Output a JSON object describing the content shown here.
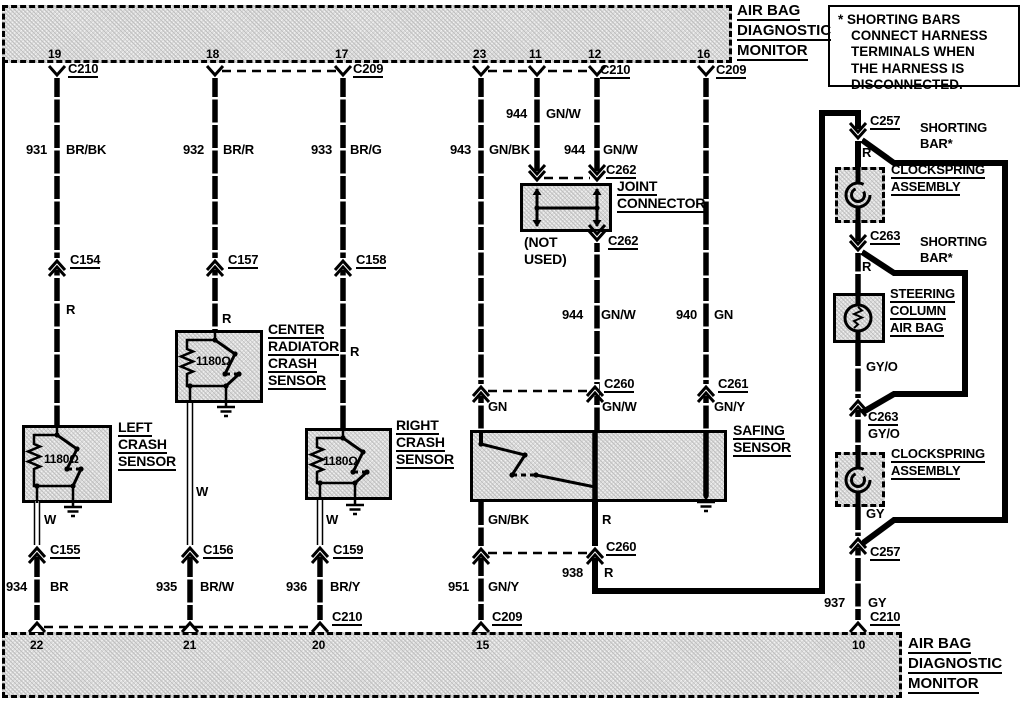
{
  "titles": {
    "top": [
      "AIR BAG",
      "DIAGNOSTIC",
      "MONITOR"
    ],
    "bottom": [
      "AIR BAG",
      "DIAGNOSTIC",
      "MONITOR"
    ]
  },
  "note": {
    "lines": [
      "* SHORTING BARS",
      "CONNECT HARNESS",
      "TERMINALS WHEN",
      "THE HARNESS IS",
      "DISCONNECTED."
    ]
  },
  "monitors": {
    "top_pins": [
      {
        "n": "19",
        "x": 48
      },
      {
        "n": "18",
        "x": 206
      },
      {
        "n": "17",
        "x": 335
      },
      {
        "n": "23",
        "x": 473
      },
      {
        "n": "11",
        "x": 529
      },
      {
        "n": "12",
        "x": 588
      },
      {
        "n": "16",
        "x": 697
      }
    ],
    "bottom_pins": [
      {
        "n": "22",
        "x": 30
      },
      {
        "n": "21",
        "x": 183
      },
      {
        "n": "20",
        "x": 312
      },
      {
        "n": "15",
        "x": 476
      },
      {
        "n": "10",
        "x": 852
      }
    ]
  },
  "labels": [
    {
      "t": "C210",
      "x": 68,
      "y": 62,
      "u": 1
    },
    {
      "t": "C209",
      "x": 353,
      "y": 62,
      "u": 1
    },
    {
      "t": "C210",
      "x": 600,
      "y": 63,
      "u": 1
    },
    {
      "t": "C209",
      "x": 716,
      "y": 63,
      "u": 1
    },
    {
      "t": "944",
      "x": 506,
      "y": 107
    },
    {
      "t": "GN/W",
      "x": 546,
      "y": 107
    },
    {
      "t": "931",
      "x": 26,
      "y": 143
    },
    {
      "t": "BR/BK",
      "x": 66,
      "y": 143
    },
    {
      "t": "932",
      "x": 183,
      "y": 143
    },
    {
      "t": "BR/R",
      "x": 223,
      "y": 143
    },
    {
      "t": "933",
      "x": 311,
      "y": 143
    },
    {
      "t": "BR/G",
      "x": 350,
      "y": 143
    },
    {
      "t": "943",
      "x": 450,
      "y": 143
    },
    {
      "t": "GN/BK",
      "x": 489,
      "y": 143
    },
    {
      "t": "944",
      "x": 564,
      "y": 143
    },
    {
      "t": "GN/W",
      "x": 603,
      "y": 143
    },
    {
      "t": "C262",
      "x": 606,
      "y": 163,
      "u": 1
    },
    {
      "t": "JOINT",
      "x": 617,
      "y": 180,
      "u": 1,
      "fs": 14
    },
    {
      "t": "CONNECTOR",
      "x": 617,
      "y": 197,
      "u": 1,
      "fs": 14
    },
    {
      "t": "(NOT",
      "x": 524,
      "y": 236,
      "fs": 14
    },
    {
      "t": "USED)",
      "x": 524,
      "y": 253,
      "fs": 14
    },
    {
      "t": "C262",
      "x": 608,
      "y": 234,
      "u": 1
    },
    {
      "t": "C154",
      "x": 70,
      "y": 253,
      "u": 1
    },
    {
      "t": "C157",
      "x": 228,
      "y": 253,
      "u": 1
    },
    {
      "t": "C158",
      "x": 356,
      "y": 253,
      "u": 1
    },
    {
      "t": "R",
      "x": 66,
      "y": 303
    },
    {
      "t": "R",
      "x": 222,
      "y": 312
    },
    {
      "t": "R",
      "x": 350,
      "y": 345
    },
    {
      "t": "CENTER",
      "x": 268,
      "y": 323,
      "u": 1,
      "fs": 14
    },
    {
      "t": "RADIATOR",
      "x": 268,
      "y": 340,
      "u": 1,
      "fs": 14
    },
    {
      "t": "CRASH",
      "x": 268,
      "y": 357,
      "u": 1,
      "fs": 14
    },
    {
      "t": "SENSOR",
      "x": 268,
      "y": 374,
      "u": 1,
      "fs": 14
    },
    {
      "t": "LEFT",
      "x": 118,
      "y": 421,
      "u": 1,
      "fs": 14
    },
    {
      "t": "CRASH",
      "x": 118,
      "y": 438,
      "u": 1,
      "fs": 14
    },
    {
      "t": "SENSOR",
      "x": 118,
      "y": 455,
      "u": 1,
      "fs": 14
    },
    {
      "t": "RIGHT",
      "x": 396,
      "y": 419,
      "u": 1,
      "fs": 14
    },
    {
      "t": "CRASH",
      "x": 396,
      "y": 436,
      "u": 1,
      "fs": 14
    },
    {
      "t": "SENSOR",
      "x": 396,
      "y": 453,
      "u": 1,
      "fs": 14
    },
    {
      "t": "1180Ω",
      "x": 44,
      "y": 453,
      "fs": 12
    },
    {
      "t": "1180Ω",
      "x": 196,
      "y": 355,
      "fs": 12
    },
    {
      "t": "1180Ω",
      "x": 323,
      "y": 455,
      "fs": 12
    },
    {
      "t": "944",
      "x": 562,
      "y": 308
    },
    {
      "t": "GN/W",
      "x": 601,
      "y": 308
    },
    {
      "t": "940",
      "x": 676,
      "y": 308
    },
    {
      "t": "GN",
      "x": 714,
      "y": 308
    },
    {
      "t": "C260",
      "x": 604,
      "y": 377,
      "u": 1
    },
    {
      "t": "C261",
      "x": 718,
      "y": 377,
      "u": 1
    },
    {
      "t": "GN",
      "x": 488,
      "y": 400
    },
    {
      "t": "GN/W",
      "x": 602,
      "y": 400
    },
    {
      "t": "GN/Y",
      "x": 714,
      "y": 400
    },
    {
      "t": "SAFING",
      "x": 733,
      "y": 424,
      "u": 1,
      "fs": 14
    },
    {
      "t": "SENSOR",
      "x": 733,
      "y": 441,
      "u": 1,
      "fs": 14
    },
    {
      "t": "GN/BK",
      "x": 488,
      "y": 513
    },
    {
      "t": "R",
      "x": 602,
      "y": 513
    },
    {
      "t": "C260",
      "x": 606,
      "y": 540,
      "u": 1
    },
    {
      "t": "938",
      "x": 562,
      "y": 566
    },
    {
      "t": "R",
      "x": 604,
      "y": 566
    },
    {
      "t": "W",
      "x": 44,
      "y": 513
    },
    {
      "t": "W",
      "x": 196,
      "y": 485
    },
    {
      "t": "W",
      "x": 326,
      "y": 513
    },
    {
      "t": "C155",
      "x": 50,
      "y": 543,
      "u": 1
    },
    {
      "t": "C156",
      "x": 203,
      "y": 543,
      "u": 1
    },
    {
      "t": "C159",
      "x": 333,
      "y": 543,
      "u": 1
    },
    {
      "t": "934",
      "x": 6,
      "y": 580
    },
    {
      "t": "BR",
      "x": 50,
      "y": 580
    },
    {
      "t": "935",
      "x": 156,
      "y": 580
    },
    {
      "t": "BR/W",
      "x": 200,
      "y": 580
    },
    {
      "t": "936",
      "x": 286,
      "y": 580
    },
    {
      "t": "BR/Y",
      "x": 330,
      "y": 580
    },
    {
      "t": "951",
      "x": 448,
      "y": 580
    },
    {
      "t": "GN/Y",
      "x": 488,
      "y": 580
    },
    {
      "t": "C210",
      "x": 332,
      "y": 610,
      "u": 1
    },
    {
      "t": "C209",
      "x": 492,
      "y": 610,
      "u": 1
    },
    {
      "t": "C210",
      "x": 870,
      "y": 610,
      "u": 1
    },
    {
      "t": "937",
      "x": 824,
      "y": 596
    },
    {
      "t": "GY",
      "x": 868,
      "y": 596
    },
    {
      "t": "C257",
      "x": 870,
      "y": 114,
      "u": 1
    },
    {
      "t": "SHORTING",
      "x": 920,
      "y": 121
    },
    {
      "t": "BAR*",
      "x": 920,
      "y": 137
    },
    {
      "t": "R",
      "x": 862,
      "y": 146
    },
    {
      "t": "CLOCKSPRING",
      "x": 891,
      "y": 163,
      "u": 1
    },
    {
      "t": "ASSEMBLY",
      "x": 891,
      "y": 180,
      "u": 1
    },
    {
      "t": "C263",
      "x": 870,
      "y": 229,
      "u": 1
    },
    {
      "t": "SHORTING",
      "x": 920,
      "y": 235
    },
    {
      "t": "BAR*",
      "x": 920,
      "y": 251
    },
    {
      "t": "R",
      "x": 862,
      "y": 260
    },
    {
      "t": "STEERING",
      "x": 890,
      "y": 287,
      "u": 1
    },
    {
      "t": "COLUMN",
      "x": 890,
      "y": 304,
      "u": 1
    },
    {
      "t": "AIR BAG",
      "x": 890,
      "y": 321,
      "u": 1
    },
    {
      "t": "GY/O",
      "x": 866,
      "y": 360
    },
    {
      "t": "C263",
      "x": 868,
      "y": 410,
      "u": 1
    },
    {
      "t": "GY/O",
      "x": 868,
      "y": 427
    },
    {
      "t": "CLOCKSPRING",
      "x": 891,
      "y": 447,
      "u": 1
    },
    {
      "t": "ASSEMBLY",
      "x": 891,
      "y": 464,
      "u": 1
    },
    {
      "t": "GY",
      "x": 866,
      "y": 507
    },
    {
      "t": "C257",
      "x": 870,
      "y": 545,
      "u": 1
    }
  ],
  "geometry": {
    "boxes": [
      {
        "name": "airbag-monitor-top",
        "x": 2,
        "y": 5,
        "w": 730,
        "h": 58,
        "style": "monitor hatch"
      },
      {
        "name": "airbag-monitor-bottom",
        "x": 2,
        "y": 632,
        "w": 900,
        "h": 66,
        "style": "monitor hatch"
      },
      {
        "name": "left-crash-sensor-box",
        "x": 22,
        "y": 425,
        "w": 90,
        "h": 78,
        "style": "sensor hatch",
        "sym": "crash",
        "entry": 57,
        "wexit": 37,
        "gnd": 73
      },
      {
        "name": "center-radiator-crash-sensor-box",
        "x": 175,
        "y": 330,
        "w": 88,
        "h": 73,
        "style": "sensor hatch",
        "sym": "crash",
        "entry": 215,
        "wexit": 190,
        "gnd": 226
      },
      {
        "name": "right-crash-sensor-box",
        "x": 305,
        "y": 428,
        "w": 87,
        "h": 72,
        "style": "sensor hatch",
        "sym": "crash",
        "entry": 343,
        "wexit": 320,
        "gnd": 355
      },
      {
        "name": "safing-sensor-box",
        "x": 470,
        "y": 430,
        "w": 257,
        "h": 72,
        "style": "sensor hatch",
        "sym": "safing"
      },
      {
        "name": "joint-connector-box",
        "x": 520,
        "y": 183,
        "w": 92,
        "h": 49,
        "style": "sensor hatch",
        "sym": "joint"
      },
      {
        "name": "clockspring-assembly-top-box",
        "x": 835,
        "y": 167,
        "w": 50,
        "h": 56,
        "style": "dashedbox hatch",
        "sym": "clockspring"
      },
      {
        "name": "steering-column-air-bag-box",
        "x": 833,
        "y": 293,
        "w": 52,
        "h": 50,
        "style": "sensor hatch",
        "sym": "squib"
      },
      {
        "name": "clockspring-assembly-bottom-box",
        "x": 835,
        "y": 452,
        "w": 50,
        "h": 55,
        "style": "dashedbox hatch",
        "sym": "clockspring"
      }
    ],
    "wires": [
      [
        [
          57,
          74
        ],
        [
          57,
          425
        ]
      ],
      [
        [
          37,
          554
        ],
        [
          37,
          633
        ]
      ],
      [
        [
          215,
          74
        ],
        [
          215,
          330
        ]
      ],
      [
        [
          190,
          554
        ],
        [
          190,
          633
        ]
      ],
      [
        [
          343,
          74
        ],
        [
          343,
          428
        ]
      ],
      [
        [
          320,
          554
        ],
        [
          320,
          633
        ]
      ],
      [
        [
          481,
          74
        ],
        [
          481,
          430
        ]
      ],
      [
        [
          481,
          502
        ],
        [
          481,
          633
        ]
      ],
      [
        [
          537,
          74
        ],
        [
          537,
          186
        ]
      ],
      [
        [
          597,
          74
        ],
        [
          597,
          186
        ]
      ],
      [
        [
          597,
          229
        ],
        [
          597,
          430
        ]
      ],
      [
        [
          706,
          74
        ],
        [
          706,
          430
        ]
      ],
      [
        [
          858,
          223
        ],
        [
          858,
          293
        ]
      ],
      [
        [
          858,
          343
        ],
        [
          858,
          452
        ]
      ],
      [
        [
          858,
          507
        ],
        [
          858,
          633
        ]
      ]
    ],
    "solids": [
      [
        [
          595,
          502
        ],
        [
          595,
          591
        ],
        [
          822,
          591
        ],
        [
          822,
          113
        ],
        [
          858,
          113
        ],
        [
          858,
          167
        ]
      ],
      [
        [
          862,
          140
        ],
        [
          894,
          163
        ],
        [
          1005,
          163
        ],
        [
          1005,
          520
        ],
        [
          894,
          520
        ],
        [
          863,
          543
        ]
      ],
      [
        [
          862,
          252
        ],
        [
          894,
          273
        ],
        [
          965,
          273
        ],
        [
          965,
          394
        ],
        [
          894,
          394
        ],
        [
          863,
          412
        ]
      ]
    ],
    "white_wires": [
      [
        [
          37,
          501
        ],
        [
          37,
          556
        ]
      ],
      [
        [
          190,
          403
        ],
        [
          190,
          556
        ]
      ],
      [
        [
          320,
          500
        ],
        [
          320,
          556
        ]
      ]
    ],
    "dashes": [
      [
        222,
        71,
        336,
        71
      ],
      [
        488,
        71,
        590,
        71
      ],
      [
        544,
        178,
        590,
        178
      ],
      [
        488,
        391,
        588,
        391
      ],
      [
        488,
        553,
        588,
        553
      ],
      [
        44,
        627,
        313,
        627
      ]
    ],
    "marks_up": [
      [
        57,
        264
      ],
      [
        215,
        264
      ],
      [
        343,
        264
      ],
      [
        37,
        551
      ],
      [
        190,
        551
      ],
      [
        320,
        551
      ],
      [
        481,
        390
      ],
      [
        595,
        390
      ],
      [
        706,
        390
      ],
      [
        481,
        552
      ],
      [
        595,
        552
      ],
      [
        858,
        404
      ],
      [
        858,
        542
      ]
    ],
    "marks_down": [
      [
        537,
        177
      ],
      [
        597,
        177
      ],
      [
        597,
        237
      ],
      [
        858,
        135
      ],
      [
        858,
        247
      ]
    ],
    "feet_top": [
      57,
      215,
      343,
      481,
      537,
      597,
      706
    ],
    "feet_top_y": 72,
    "feet_bottom": [
      37,
      190,
      320,
      481,
      858
    ],
    "feet_bottom_y": 626,
    "grounds": [
      [
        73,
        501
      ],
      [
        226,
        401
      ],
      [
        355,
        499
      ],
      [
        706,
        496
      ]
    ]
  }
}
